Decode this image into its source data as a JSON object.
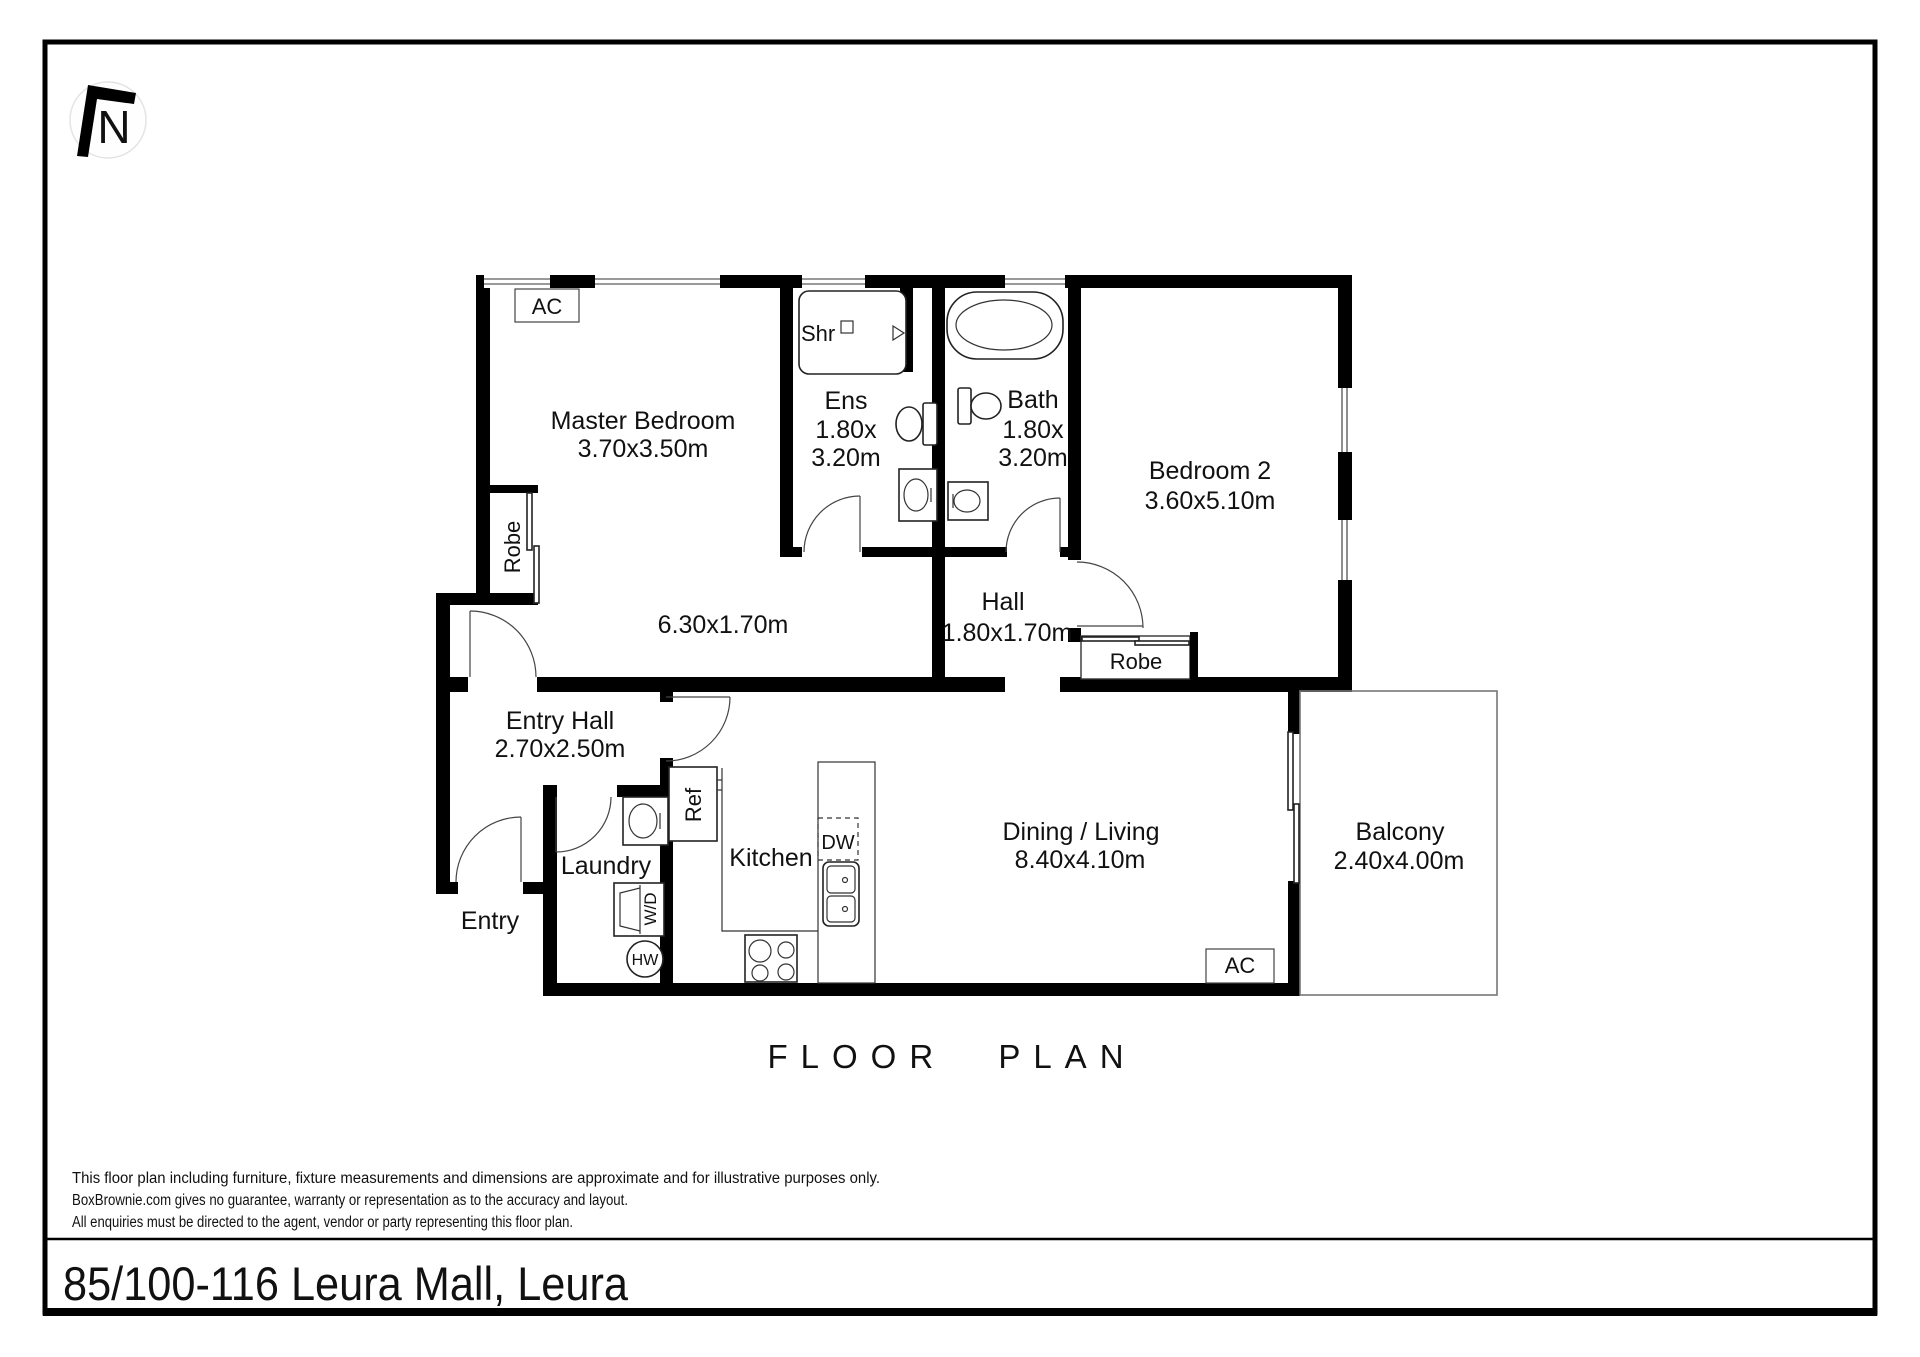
{
  "north_indicator": {
    "label": "N"
  },
  "plan": {
    "rooms": {
      "master": {
        "name": "Master Bedroom",
        "dims": "3.70x3.50m"
      },
      "corridor": {
        "dims": "6.30x1.70m"
      },
      "ens": {
        "name": "Ens",
        "dims1": "1.80x",
        "dims2": "3.20m"
      },
      "bath": {
        "name": "Bath",
        "dims1": "1.80x",
        "dims2": "3.20m"
      },
      "bedroom2": {
        "name": "Bedroom 2",
        "dims": "3.60x5.10m"
      },
      "hall": {
        "name": "Hall",
        "dims": "1.80x1.70m"
      },
      "entry_hall": {
        "name": "Entry Hall",
        "dims": "2.70x2.50m"
      },
      "entry": {
        "name": "Entry"
      },
      "laundry": {
        "name": "Laundry"
      },
      "kitchen": {
        "name": "Kitchen"
      },
      "dining": {
        "name": "Dining / Living",
        "dims": "8.40x4.10m"
      },
      "balcony": {
        "name": "Balcony",
        "dims": "2.40x4.00m"
      }
    },
    "fixtures": {
      "ac": "AC",
      "shr": "Shr",
      "robe": "Robe",
      "ref": "Ref",
      "dw": "DW",
      "wd": "W/D",
      "hw": "HW"
    }
  },
  "title": {
    "text": "FLOOR PLAN"
  },
  "footer": {
    "disclaimer": [
      "This floor plan including furniture, fixture measurements and dimensions are approximate and for illustrative purposes only.",
      "BoxBrownie.com gives no guarantee, warranty or representation as to the accuracy and layout.",
      "All enquiries must be directed to the agent, vendor or party representing this floor plan."
    ],
    "address": "85/100-116 Leura Mall, Leura"
  },
  "colors": {
    "wall": "#000000",
    "accent": "#111111",
    "balcony_outline": "#777777"
  }
}
